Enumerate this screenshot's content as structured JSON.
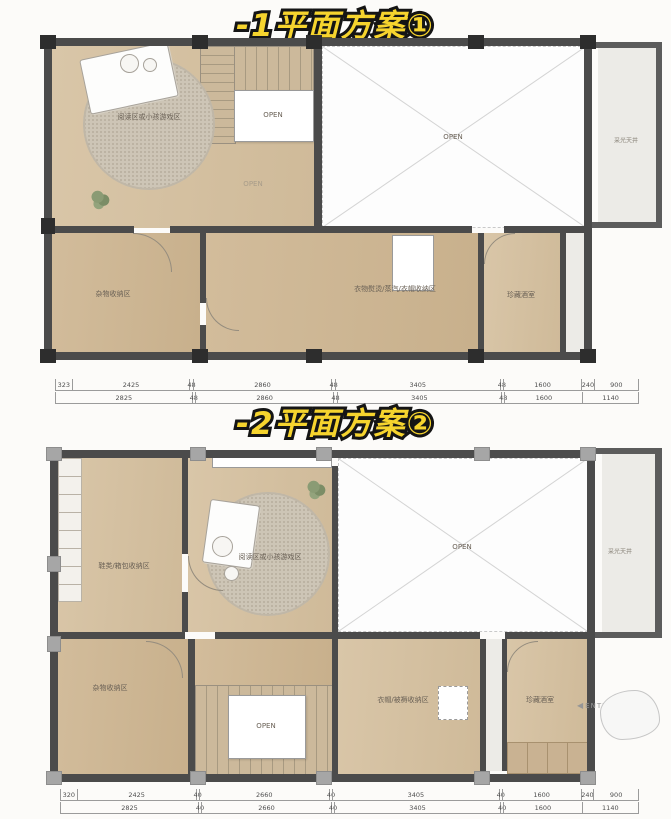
{
  "meta": {
    "type": "basement-floor-plan-comparison"
  },
  "colors": {
    "title_yellow": "#f6d42e",
    "title_outline": "#151515",
    "wall_dark": "#4b4b4b",
    "column_dark": "#2d2d2d",
    "column_light": "#a6a6a6",
    "wood_floor": "#d7c4a5",
    "lightwell_floor": "#ecebe7"
  },
  "title1": "-1平面方案①",
  "title2": "-2平面方案②",
  "plan1": {
    "labels": {
      "rug_area": "阅读区或小孩游戏区",
      "stair_open": "OPEN",
      "floor_open": "OPEN",
      "void_open": "OPEN",
      "lightwell": "采光天井",
      "storage": "杂物收纳区",
      "laundry": "衣物熨烫/蒸汽/衣帽收纳区",
      "wine": "珍藏酒室"
    },
    "dims": {
      "row1": [
        "323",
        "2425",
        "48",
        "2860",
        "48",
        "3405",
        "48",
        "1600",
        "240",
        "900"
      ],
      "row2": [
        "2825",
        "48",
        "2860",
        "48",
        "3405",
        "48",
        "1600",
        "1140"
      ]
    }
  },
  "plan2": {
    "labels": {
      "shoes": "鞋类/箱包收纳区",
      "rug_area": "阅读区或小孩游戏区",
      "void_open": "OPEN",
      "lightwell": "采光天井",
      "storage": "杂物收纳区",
      "stair_open": "OPEN",
      "wardrobe": "衣帽/被褥收纳区",
      "wine": "珍藏酒室",
      "enter": "ENTER"
    },
    "dims": {
      "row1": [
        "320",
        "2425",
        "40",
        "2660",
        "40",
        "3405",
        "40",
        "1600",
        "240",
        "900"
      ],
      "row2": [
        "2825",
        "40",
        "2660",
        "40",
        "3405",
        "40",
        "1600",
        "1140"
      ]
    }
  }
}
